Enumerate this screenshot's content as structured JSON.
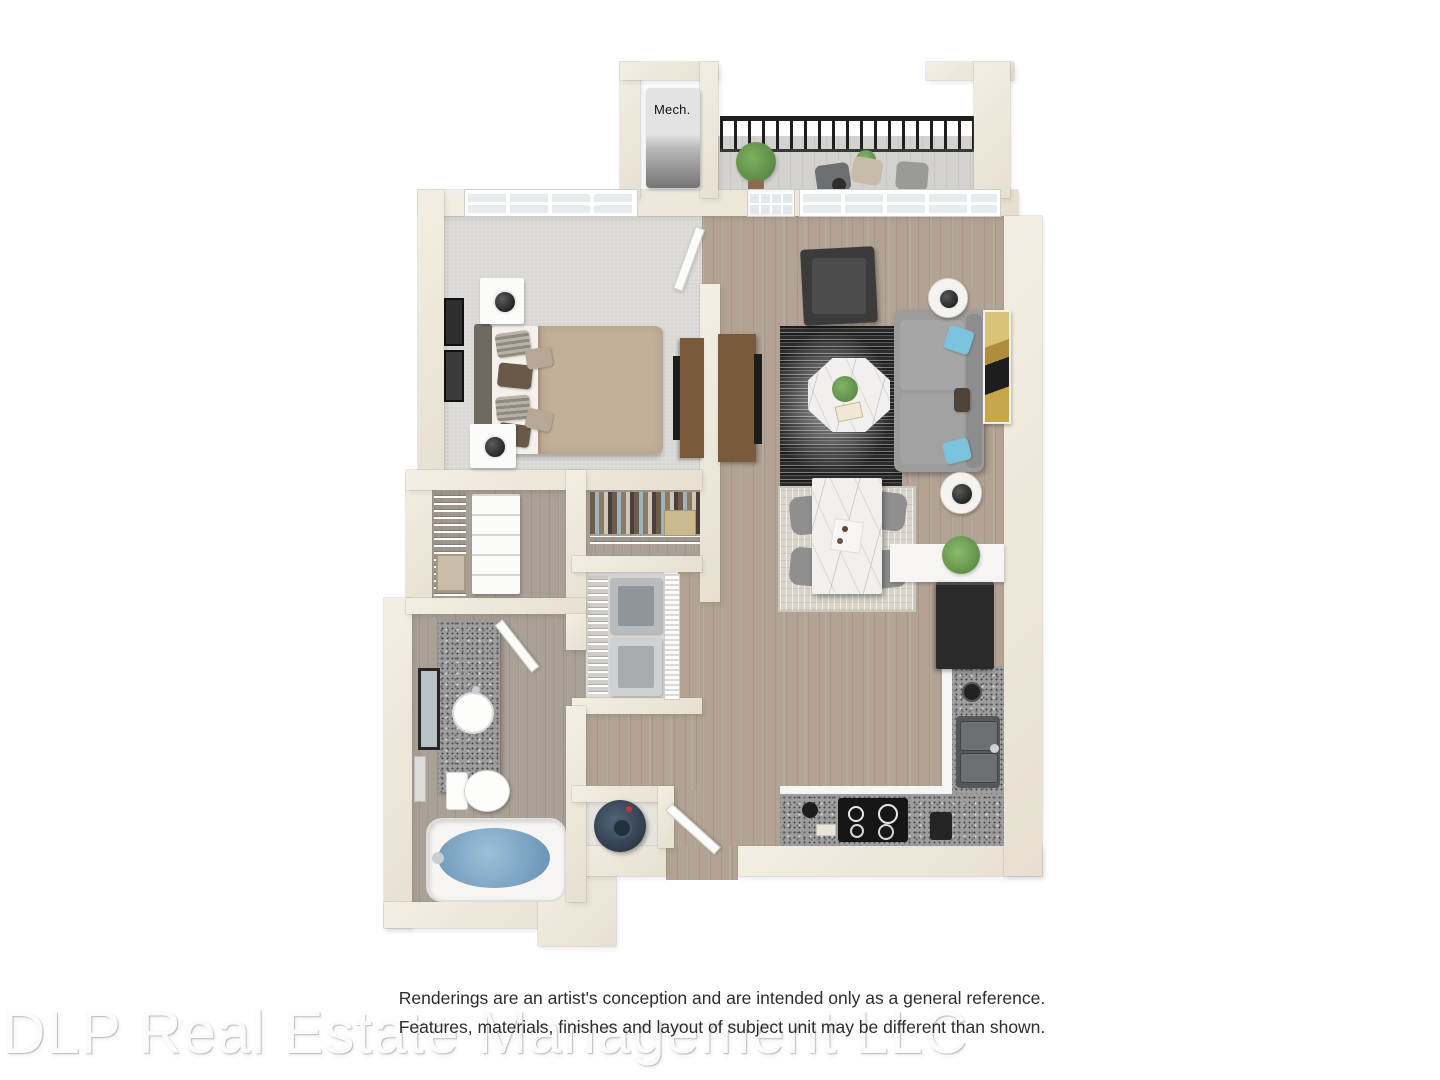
{
  "labels": {
    "mech_closet": "Mech."
  },
  "disclaimer": {
    "line1": "Renderings are an artist's conception and are intended only as a general reference.",
    "line2": "Features, materials, finishes and layout of subject unit may be different than shown."
  },
  "watermark": {
    "text": "DLP Real Estate Management LLC"
  },
  "palette": {
    "wall": "#ece6da",
    "carpet": "#d9d8d4",
    "wood": "#b2a394",
    "bath_wood": "#a9a096",
    "balcony_floor": "#d4d2ce",
    "railing": "#1f1f1f",
    "duvet": "#c3b09a",
    "sheet": "#f4f1ec",
    "headboard": "#6f6a60",
    "furniture_wood": "#7a5a3d",
    "tv_black": "#1c1c1c",
    "sofa": "#9c9c9c",
    "pillow_blue": "#7cc4de",
    "pillow_brown": "#6a5848",
    "pillow_tan": "#b7a893",
    "rug_light": "#d8d4ca",
    "marble": "#f1f0ee",
    "chair_gray": "#8f8f8f",
    "cabinet_white": "#f6f5f2",
    "fridge_black": "#2a2a2a",
    "sink_dark": "#54585a",
    "cooktop_black": "#161616",
    "water_blue": "#7fa9c6",
    "heater_navy": "#3c4a5c",
    "plant_green": "#5d8f4e",
    "accent_chair": "#3b3b3b"
  },
  "scene": {
    "type": "3d-floor-plan-rendering",
    "unit": "one-bedroom apartment",
    "rooms": [
      {
        "name": "balcony",
        "items": [
          "black metal railing",
          "two lounge chairs",
          "potted plants",
          "small table"
        ]
      },
      {
        "name": "mechanical-closet",
        "items": [
          "hvac unit labeled Mech."
        ]
      },
      {
        "name": "bedroom",
        "items": [
          "bed with tan duvet and pillows",
          "two nightstands with lamps",
          "wall art",
          "dresser with tv",
          "large window",
          "carpet floor"
        ]
      },
      {
        "name": "living-room",
        "items": [
          "gray sofa with blue pillows",
          "octagonal marble coffee table",
          "dark striped rug",
          "accent chair",
          "two round side tables with lamps",
          "media console with tv",
          "wall art",
          "french door to balcony",
          "windows"
        ]
      },
      {
        "name": "dining-area",
        "items": [
          "marble dining table",
          "four gray chairs",
          "light patterned rug",
          "potted plant"
        ]
      },
      {
        "name": "kitchen",
        "items": [
          "l-shaped granite counter",
          "black refrigerator",
          "double sink",
          "black cooktop",
          "white cabinets"
        ]
      },
      {
        "name": "walk-in-closet",
        "items": [
          "wire shelving",
          "white dresser",
          "basket"
        ]
      },
      {
        "name": "coat-closet",
        "items": [
          "hanging clothes",
          "wire shelf",
          "storage box"
        ]
      },
      {
        "name": "laundry-closet",
        "items": [
          "washer",
          "dryer",
          "wire shelf",
          "louvered doors"
        ]
      },
      {
        "name": "bathroom",
        "items": [
          "granite vanity with round sink",
          "mirror",
          "toilet",
          "bathtub with water",
          "towel bar"
        ]
      },
      {
        "name": "water-heater-closet",
        "items": [
          "round water heater"
        ]
      },
      {
        "name": "entry",
        "items": [
          "open entry door"
        ]
      }
    ]
  }
}
